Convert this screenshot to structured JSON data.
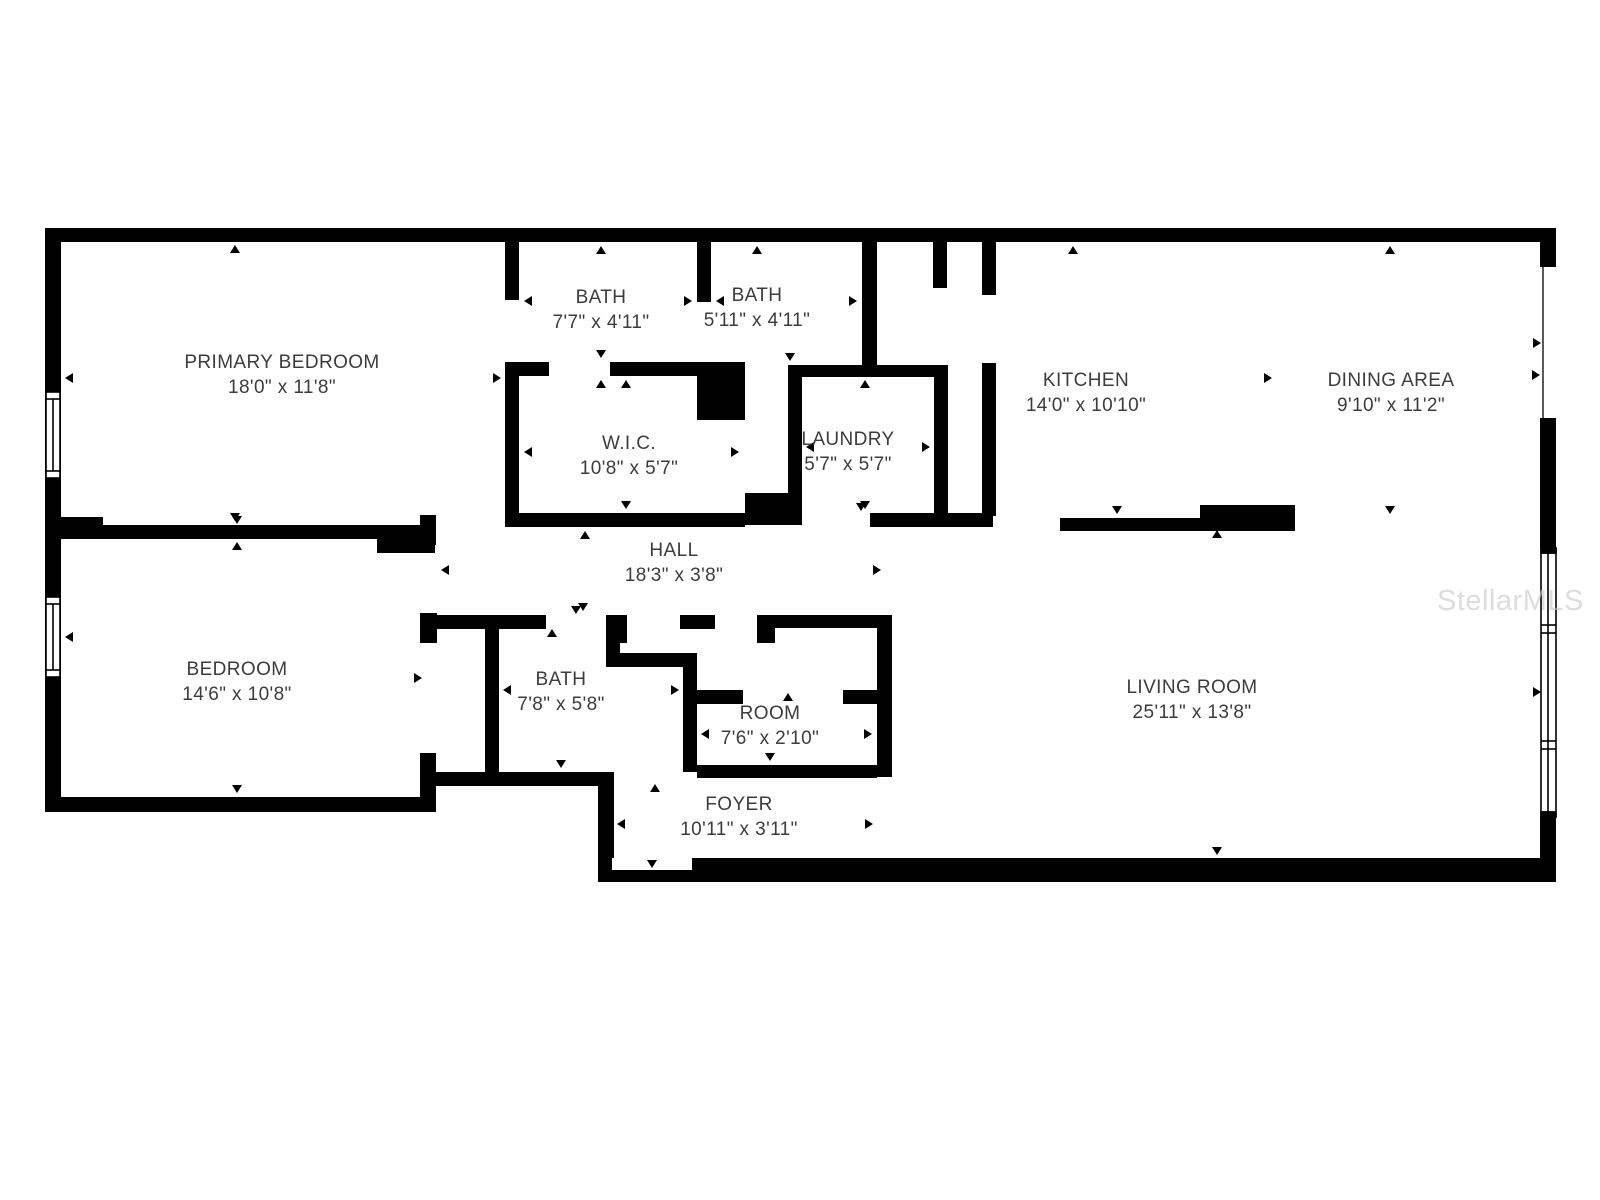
{
  "floorplan": {
    "watermark": "StellarMLS",
    "wall_color": "#000000",
    "label_color": "#3c3c3c",
    "rooms": [
      {
        "id": "primary-bedroom",
        "name": "PRIMARY BEDROOM",
        "dims": "18'0\" x 11'8\""
      },
      {
        "id": "bath-1",
        "name": "BATH",
        "dims": "7'7\" x 4'11\""
      },
      {
        "id": "bath-2",
        "name": "BATH",
        "dims": "5'11\" x 4'11\""
      },
      {
        "id": "kitchen",
        "name": "KITCHEN",
        "dims": "14'0\" x 10'10\""
      },
      {
        "id": "dining-area",
        "name": "DINING AREA",
        "dims": "9'10\" x 11'2\""
      },
      {
        "id": "wic",
        "name": "W.I.C.",
        "dims": "10'8\" x 5'7\""
      },
      {
        "id": "laundry",
        "name": "LAUNDRY",
        "dims": "5'7\" x 5'7\""
      },
      {
        "id": "hall",
        "name": "HALL",
        "dims": "18'3\" x 3'8\""
      },
      {
        "id": "bedroom",
        "name": "BEDROOM",
        "dims": "14'6\" x 10'8\""
      },
      {
        "id": "bath-3",
        "name": "BATH",
        "dims": "7'8\" x 5'8\""
      },
      {
        "id": "room",
        "name": "ROOM",
        "dims": "7'6\" x 2'10\""
      },
      {
        "id": "foyer",
        "name": "FOYER",
        "dims": "10'11\" x 3'11\""
      },
      {
        "id": "living-room",
        "name": "LIVING ROOM",
        "dims": "25'11\" x 13'8\""
      }
    ]
  }
}
